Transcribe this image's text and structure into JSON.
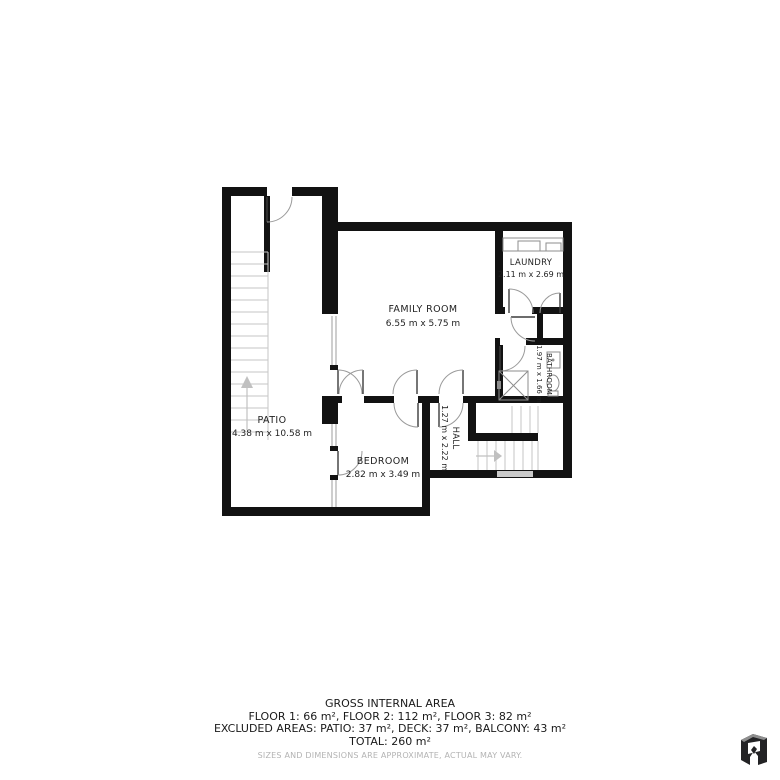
{
  "floorplan": {
    "rooms": [
      {
        "name": "PATIO",
        "dims": "4.38 m x 10.58 m"
      },
      {
        "name": "FAMILY ROOM",
        "dims": "6.55 m x 5.75 m"
      },
      {
        "name": "LAUNDRY",
        "dims": "2.11 m x 2.69 m"
      },
      {
        "name": "BATHROOM",
        "dims": "1.97 m x 1.66 m"
      },
      {
        "name": "HALL",
        "dims": "1.27 m x 2.22 m"
      },
      {
        "name": "BEDROOM",
        "dims": "2.82 m x 3.49 m"
      }
    ]
  },
  "summary": {
    "title": "GROSS INTERNAL AREA",
    "floors": "FLOOR 1: 66 m², FLOOR 2: 112 m², FLOOR 3: 82 m²",
    "excluded": "EXCLUDED AREAS: PATIO: 37 m², DECK: 37 m², BALCONY: 43 m²",
    "total": "TOTAL: 260 m²",
    "disclaimer": "SIZES AND DIMENSIONS ARE APPROXIMATE, ACTUAL MAY VARY."
  },
  "branding": {
    "logo": "matterport-style-m-logo"
  },
  "colors": {
    "wall": "#121212",
    "text": "#1f1f1f",
    "muted_text": "#b3b3b3",
    "treads": "#c6c6c6",
    "door_swing": "#9a9a9a",
    "fixtures": "#8d8d8d",
    "logo_dark": "#232325",
    "logo_gray": "#8e8e8e"
  }
}
